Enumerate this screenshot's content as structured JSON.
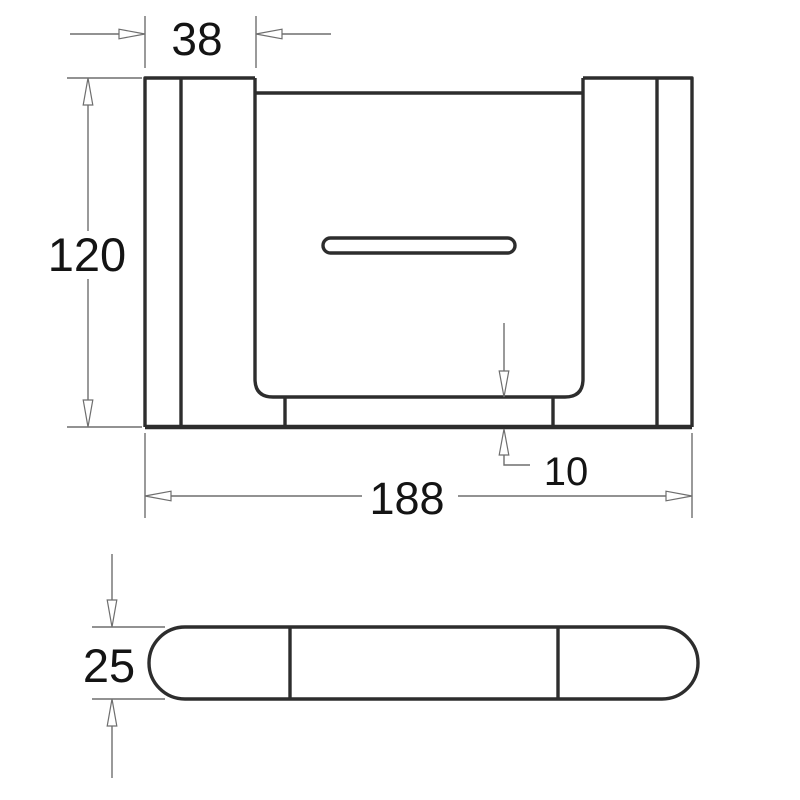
{
  "drawing": {
    "dimensions": {
      "bracket_width": "38",
      "overall_height": "120",
      "base_offset": "10",
      "overall_width": "188",
      "profile_depth": "25"
    },
    "colors": {
      "outline": "#2d2d2d",
      "dimline": "#6e6e6e",
      "ink": "#141414",
      "background": "#ffffff"
    }
  }
}
